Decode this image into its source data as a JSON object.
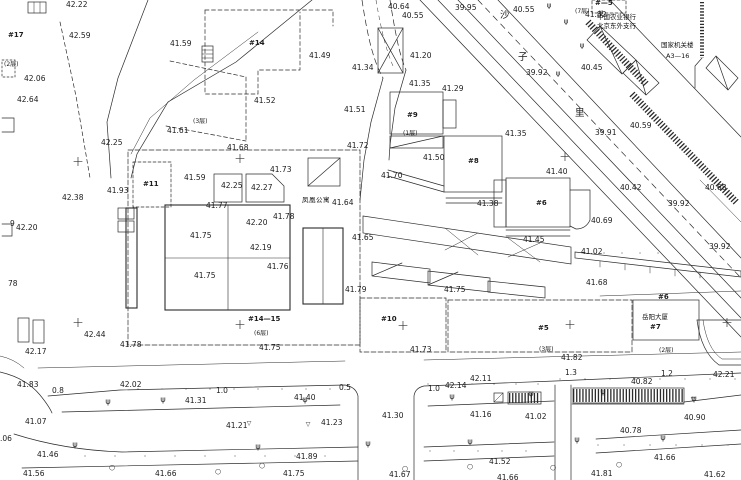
{
  "drawing": {
    "kind": "cadastral-topographic-site-plan",
    "background_color": "#ffffff",
    "line_color": "#2b2b2b"
  },
  "spot_elevations": [
    {
      "t": "42.22",
      "x": 66,
      "y": 1
    },
    {
      "t": "42.59",
      "x": 69,
      "y": 32
    },
    {
      "t": "41.59",
      "x": 170,
      "y": 40
    },
    {
      "t": "42.06",
      "x": 24,
      "y": 75
    },
    {
      "t": "42.64",
      "x": 17,
      "y": 96
    },
    {
      "t": "41.61",
      "x": 167,
      "y": 127
    },
    {
      "t": "42.25",
      "x": 101,
      "y": 139
    },
    {
      "t": "41.68",
      "x": 227,
      "y": 144
    },
    {
      "t": "41.73",
      "x": 270,
      "y": 166
    },
    {
      "t": "41.59",
      "x": 184,
      "y": 174
    },
    {
      "t": "42.25",
      "x": 221,
      "y": 182
    },
    {
      "t": "42.27",
      "x": 251,
      "y": 184
    },
    {
      "t": "41.93",
      "x": 107,
      "y": 187
    },
    {
      "t": "42.38",
      "x": 62,
      "y": 194
    },
    {
      "t": "41.77",
      "x": 206,
      "y": 202
    },
    {
      "t": "42.20",
      "x": 16,
      "y": 224
    },
    {
      "t": "42.20",
      "x": 246,
      "y": 219
    },
    {
      "t": "42.19",
      "x": 250,
      "y": 244
    },
    {
      "t": "41.75",
      "x": 190,
      "y": 232
    },
    {
      "t": "41.75",
      "x": 194,
      "y": 272
    },
    {
      "t": "41.78",
      "x": 273,
      "y": 213
    },
    {
      "t": "41.76",
      "x": 267,
      "y": 263
    },
    {
      "t": "41.64",
      "x": 332,
      "y": 199
    },
    {
      "t": "41.65",
      "x": 352,
      "y": 234
    },
    {
      "t": "41.70",
      "x": 381,
      "y": 172
    },
    {
      "t": "41.79",
      "x": 345,
      "y": 286
    },
    {
      "t": "41.75",
      "x": 444,
      "y": 286
    },
    {
      "t": "40.64",
      "x": 388,
      "y": 3
    },
    {
      "t": "40.55",
      "x": 402,
      "y": 12
    },
    {
      "t": "39.95",
      "x": 455,
      "y": 4
    },
    {
      "t": "41.49",
      "x": 309,
      "y": 52
    },
    {
      "t": "41.52",
      "x": 254,
      "y": 97
    },
    {
      "t": "41.34",
      "x": 352,
      "y": 64
    },
    {
      "t": "41.51",
      "x": 344,
      "y": 106
    },
    {
      "t": "41.72",
      "x": 347,
      "y": 142
    },
    {
      "t": "41.50",
      "x": 423,
      "y": 154
    },
    {
      "t": "41.20",
      "x": 410,
      "y": 52
    },
    {
      "t": "41.35",
      "x": 409,
      "y": 80
    },
    {
      "t": "41.29",
      "x": 442,
      "y": 85
    },
    {
      "t": "41.35",
      "x": 505,
      "y": 130
    },
    {
      "t": "41.40",
      "x": 546,
      "y": 168
    },
    {
      "t": "41.38",
      "x": 477,
      "y": 200
    },
    {
      "t": "41.45",
      "x": 523,
      "y": 236
    },
    {
      "t": "40.55",
      "x": 513,
      "y": 6
    },
    {
      "t": "41.82",
      "x": 585,
      "y": 11
    },
    {
      "t": "40.45",
      "x": 581,
      "y": 64
    },
    {
      "t": "39.92",
      "x": 526,
      "y": 69
    },
    {
      "t": "39.91",
      "x": 595,
      "y": 129
    },
    {
      "t": "40.59",
      "x": 630,
      "y": 122
    },
    {
      "t": "40.42",
      "x": 620,
      "y": 184
    },
    {
      "t": "39.92",
      "x": 668,
      "y": 200
    },
    {
      "t": "40.68",
      "x": 705,
      "y": 184
    },
    {
      "t": "40.69",
      "x": 591,
      "y": 217
    },
    {
      "t": "39.92",
      "x": 709,
      "y": 243
    },
    {
      "t": "41.02",
      "x": 581,
      "y": 248
    },
    {
      "t": "41.68",
      "x": 586,
      "y": 279
    },
    {
      "t": "42.17",
      "x": 25,
      "y": 348
    },
    {
      "t": "42.44",
      "x": 84,
      "y": 331
    },
    {
      "t": "41.78",
      "x": 120,
      "y": 341
    },
    {
      "t": "41.83",
      "x": 17,
      "y": 381
    },
    {
      "t": "42.02",
      "x": 120,
      "y": 381
    },
    {
      "t": "41.31",
      "x": 185,
      "y": 397
    },
    {
      "t": "41.07",
      "x": 25,
      "y": 418
    },
    {
      "t": "41.21",
      "x": 226,
      "y": 422
    },
    {
      "t": "41.46",
      "x": 37,
      "y": 451
    },
    {
      "t": "41.56",
      "x": 23,
      "y": 470
    },
    {
      "t": "41.66",
      "x": 155,
      "y": 470
    },
    {
      "t": "41.89",
      "x": 296,
      "y": 453
    },
    {
      "t": "41.75",
      "x": 283,
      "y": 470
    },
    {
      "t": "41.75",
      "x": 259,
      "y": 344
    },
    {
      "t": "41.73",
      "x": 410,
      "y": 346
    },
    {
      "t": "41.40",
      "x": 294,
      "y": 394
    },
    {
      "t": "41.23",
      "x": 321,
      "y": 419
    },
    {
      "t": "42.14",
      "x": 445,
      "y": 382
    },
    {
      "t": "42.11",
      "x": 470,
      "y": 375
    },
    {
      "t": "41.30",
      "x": 382,
      "y": 412
    },
    {
      "t": "41.16",
      "x": 470,
      "y": 411
    },
    {
      "t": "41.67",
      "x": 389,
      "y": 471
    },
    {
      "t": "41.82",
      "x": 561,
      "y": 354
    },
    {
      "t": "40.82",
      "x": 631,
      "y": 378
    },
    {
      "t": "42.21",
      "x": 713,
      "y": 371
    },
    {
      "t": "41.02",
      "x": 525,
      "y": 413
    },
    {
      "t": "40.90",
      "x": 684,
      "y": 414
    },
    {
      "t": "40.78",
      "x": 620,
      "y": 427
    },
    {
      "t": "41.52",
      "x": 489,
      "y": 458
    },
    {
      "t": "41.66",
      "x": 654,
      "y": 454
    },
    {
      "t": "41.66",
      "x": 497,
      "y": 474
    },
    {
      "t": "41.81",
      "x": 591,
      "y": 470
    },
    {
      "t": "41.62",
      "x": 704,
      "y": 471
    }
  ],
  "road_widths": [
    {
      "t": "0.8",
      "x": 52,
      "y": 387
    },
    {
      "t": "1.0",
      "x": 216,
      "y": 387
    },
    {
      "t": "0.5",
      "x": 339,
      "y": 384
    },
    {
      "t": "1.0",
      "x": 428,
      "y": 385
    },
    {
      "t": "1.3",
      "x": 565,
      "y": 369
    },
    {
      "t": "1.2",
      "x": 661,
      "y": 370
    }
  ],
  "building_labels": [
    {
      "t": "#17",
      "x": 8,
      "y": 32
    },
    {
      "t": "#14",
      "x": 249,
      "y": 40
    },
    {
      "t": "#11",
      "x": 143,
      "y": 181
    },
    {
      "t": "#—5",
      "x": 595,
      "y": 0
    },
    {
      "t": "#9",
      "x": 407,
      "y": 112
    },
    {
      "t": "#8",
      "x": 468,
      "y": 158
    },
    {
      "t": "#6",
      "x": 536,
      "y": 200
    },
    {
      "t": "#10",
      "x": 381,
      "y": 316
    },
    {
      "t": "#14—15",
      "x": 248,
      "y": 316
    },
    {
      "t": "#5",
      "x": 538,
      "y": 325
    },
    {
      "t": "#7",
      "x": 650,
      "y": 324
    },
    {
      "t": "#6",
      "x": 658,
      "y": 294
    }
  ],
  "floor_labels": [
    {
      "t": "(2层)",
      "x": 4,
      "y": 62
    },
    {
      "t": "(3层)",
      "x": 193,
      "y": 119
    },
    {
      "t": "(7层)",
      "x": 575,
      "y": 9
    },
    {
      "t": "(1层)",
      "x": 403,
      "y": 131
    },
    {
      "t": "(6层)",
      "x": 254,
      "y": 331
    },
    {
      "t": "(3层)",
      "x": 539,
      "y": 347
    },
    {
      "t": "(2层)",
      "x": 659,
      "y": 348
    }
  ],
  "misc_labels": [
    {
      "t": "9",
      "x": 10,
      "y": 220
    },
    {
      "t": "78",
      "x": 8,
      "y": 280
    },
    {
      "t": ".06",
      "x": 0,
      "y": 435
    }
  ],
  "name_annotations": [
    {
      "t": "凤凰公寓",
      "x": 302,
      "y": 197,
      "cls": "cn wide"
    },
    {
      "t": "岳阳大厦",
      "x": 642,
      "y": 314,
      "cls": "cn"
    },
    {
      "t": "中国农业银行",
      "x": 597,
      "y": 14,
      "cls": "cn"
    },
    {
      "t": "北京东外支行",
      "x": 597,
      "y": 23,
      "cls": "cn"
    },
    {
      "t": "国家机关楼",
      "x": 661,
      "y": 42,
      "cls": "cn"
    },
    {
      "t": "A3—16",
      "x": 666,
      "y": 53,
      "cls": "cn"
    }
  ],
  "street_chars": [
    {
      "t": "沙",
      "x": 500,
      "y": 11
    },
    {
      "t": "子",
      "x": 518,
      "y": 53
    },
    {
      "t": "里",
      "x": 575,
      "y": 109
    }
  ],
  "symbols": {
    "crosses": [
      [
        78,
        162
      ],
      [
        240,
        159
      ],
      [
        565,
        157
      ],
      [
        78,
        323
      ],
      [
        240,
        325
      ],
      [
        403,
        326
      ],
      [
        570,
        325
      ],
      [
        727,
        323
      ]
    ],
    "benchmarks": [
      [
        249,
        424
      ],
      [
        693,
        400
      ],
      [
        308,
        425
      ]
    ],
    "lamps": [
      [
        108,
        402
      ],
      [
        163,
        400
      ],
      [
        305,
        400
      ],
      [
        452,
        397
      ],
      [
        531,
        394
      ],
      [
        603,
        392
      ],
      [
        694,
        399
      ],
      [
        75,
        445
      ],
      [
        258,
        447
      ],
      [
        368,
        444
      ],
      [
        470,
        442
      ],
      [
        577,
        440
      ],
      [
        663,
        438
      ]
    ],
    "trees_round": [
      [
        218,
        472
      ],
      [
        262,
        466
      ],
      [
        405,
        469
      ],
      [
        470,
        467
      ],
      [
        553,
        468
      ],
      [
        619,
        465
      ],
      [
        112,
        468
      ]
    ],
    "trees_top": [
      [
        549,
        6
      ],
      [
        566,
        22
      ],
      [
        582,
        46
      ],
      [
        601,
        13
      ],
      [
        558,
        74
      ]
    ]
  },
  "dot_rows": [
    {
      "y": 390,
      "x1": 138,
      "x2": 335,
      "step": 24
    },
    {
      "y": 385,
      "x1": 428,
      "x2": 545,
      "step": 22
    },
    {
      "y": 380,
      "x1": 560,
      "x2": 738,
      "step": 25
    },
    {
      "y": 457,
      "x1": 85,
      "x2": 340,
      "step": 30
    },
    {
      "y": 452,
      "x1": 430,
      "x2": 548,
      "step": 24
    },
    {
      "y": 446,
      "x1": 598,
      "x2": 735,
      "step": 26
    },
    {
      "y": 254,
      "x1": 604,
      "x2": 660,
      "step": 18
    }
  ],
  "glyphs": {
    "cross": "+",
    "lamp": "ψ",
    "tree": "ψ",
    "bench": "▽",
    "round_tree": "○",
    "dot": "·"
  }
}
